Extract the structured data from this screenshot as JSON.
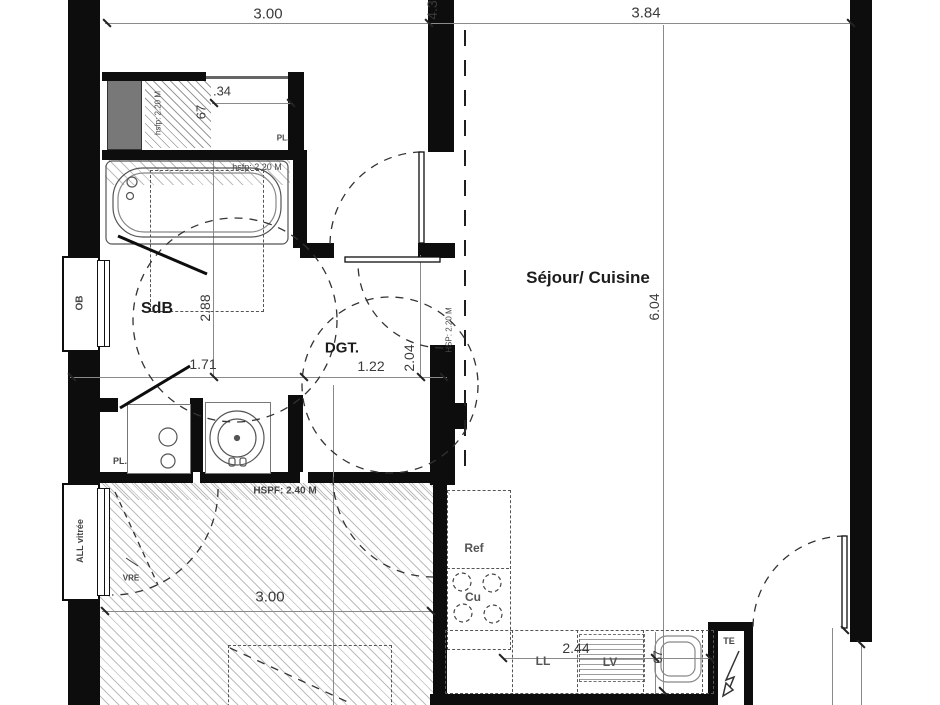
{
  "rooms": {
    "sdb": "SdB",
    "dgt": "DGT.",
    "sejour": "Séjour/ Cuisine"
  },
  "dims": {
    "top_left": "3.00",
    "top_right": "3.84",
    "top_vert": "4.3",
    "closet_dot34": ".34",
    "closet_67": "67",
    "sdb_v": "2.88",
    "sdb_h": "1.71",
    "dgt_h": "1.22",
    "dgt_v": "2.04",
    "sejour_v": "6.04",
    "bottom_room": "3.00",
    "kitchen_w": "2.44",
    "kitchen_67": "67"
  },
  "heights": {
    "closet": "hsfp: 2.20 M",
    "bath": "hsfp: 2.20 M",
    "doorway": "HSP: 2.20 M",
    "bottom_zone": "HSPF: 2.40 M"
  },
  "fixtures": {
    "placard_top": "PL.",
    "placard_mid": "PL.",
    "window_ob": "OB",
    "window_all": "ALL vitrée",
    "shutter": "VRE",
    "fridge": "Ref",
    "cooktop": "Cu",
    "washing_machine": "LL",
    "dishwasher": "LV",
    "elec_panel": "TE"
  },
  "colors": {
    "wall": "#0d0d0d",
    "dim_line": "#8a8a8a",
    "dashed": "#444444",
    "duct_fill": "#787878",
    "hatch": "#bdbdbd"
  }
}
